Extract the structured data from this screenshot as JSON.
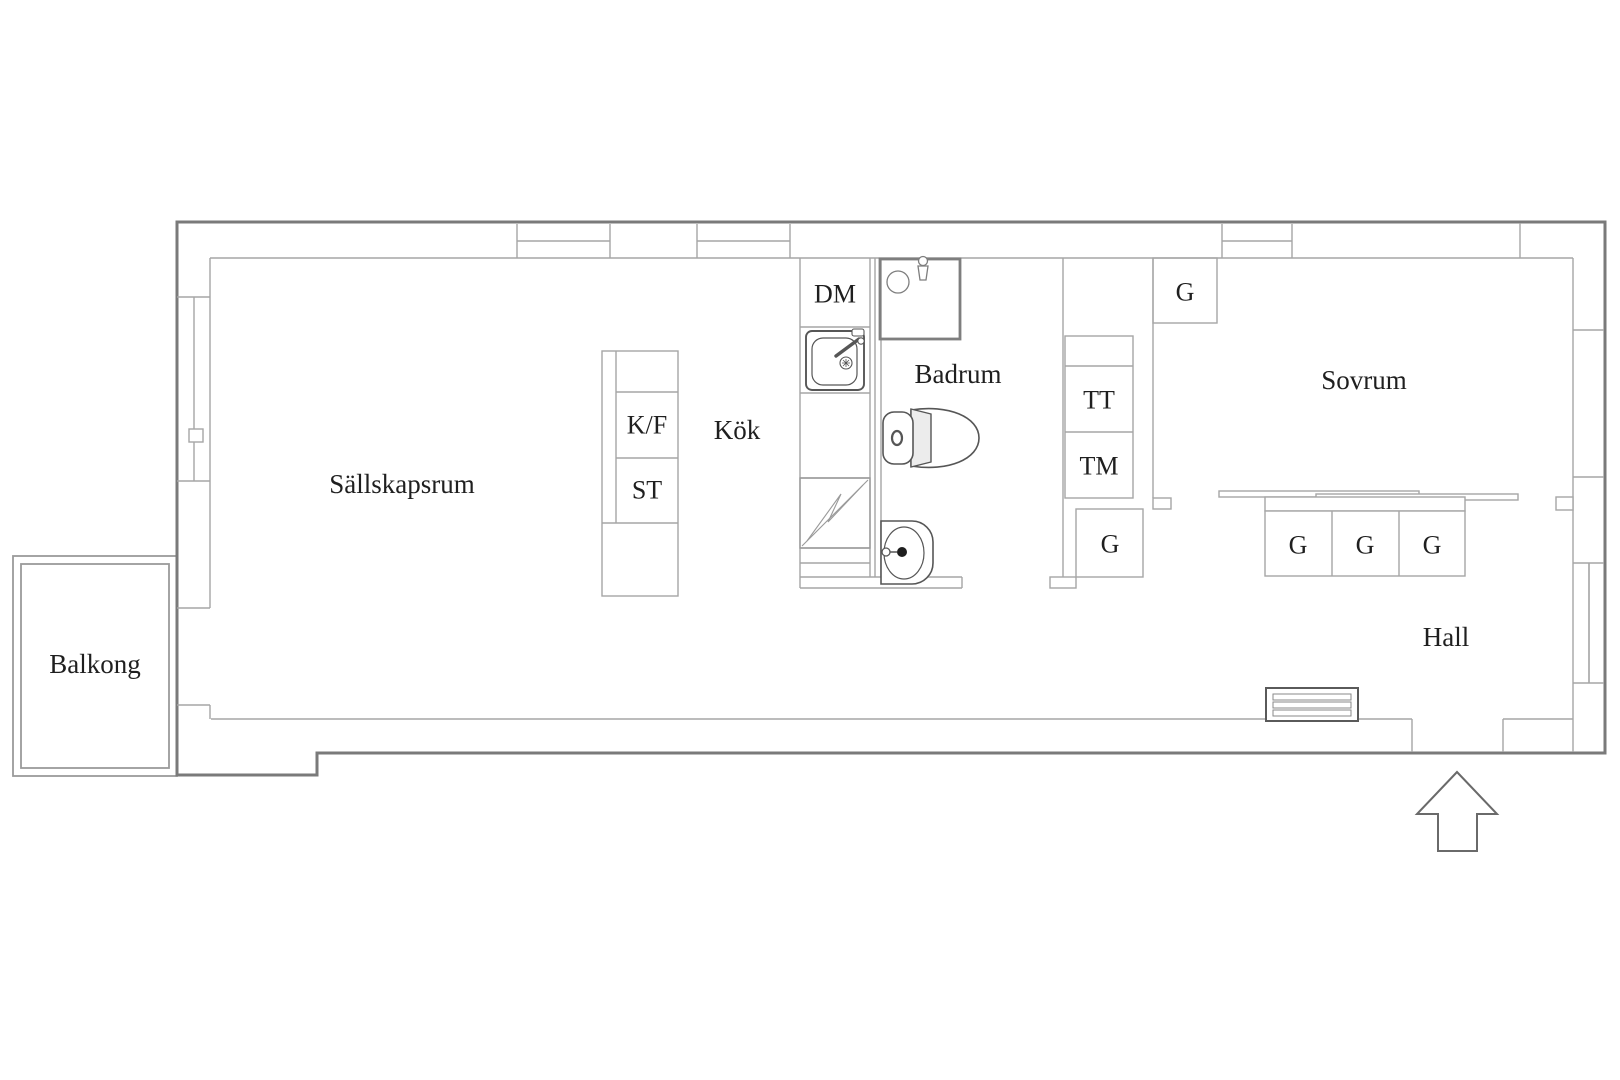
{
  "colors": {
    "background": "#ffffff",
    "exterior_wall": "#7a7a7a",
    "interior_line": "#a6a6a6",
    "fixture_line": "#565656",
    "text": "#1f1f1f"
  },
  "rooms": [
    {
      "id": "sallskapsrum",
      "label": "Sällskapsrum"
    },
    {
      "id": "balkong",
      "label": "Balkong"
    },
    {
      "id": "kok",
      "label": "Kök"
    },
    {
      "id": "badrum",
      "label": "Badrum"
    },
    {
      "id": "sovrum",
      "label": "Sovrum"
    },
    {
      "id": "hall",
      "label": "Hall"
    }
  ],
  "fixtures": [
    {
      "id": "fridge-freezer",
      "label": "K/F"
    },
    {
      "id": "tall-cabinet",
      "label": "ST"
    },
    {
      "id": "dishwasher",
      "label": "DM"
    },
    {
      "id": "tumble-dryer",
      "label": "TT"
    },
    {
      "id": "washing-machine",
      "label": "TM"
    },
    {
      "id": "wardrobe-bedroom",
      "label": "G"
    },
    {
      "id": "wardrobe-hall",
      "label": "G"
    },
    {
      "id": "wardrobe-closet-left",
      "label": "G"
    },
    {
      "id": "wardrobe-closet-middle",
      "label": "G"
    },
    {
      "id": "wardrobe-closet-right",
      "label": "G"
    }
  ],
  "icons": [
    "shower-icon",
    "toilet-icon",
    "washbasin-icon",
    "kitchen-sink-icon",
    "stove-icon",
    "vent-grille-icon",
    "entrance-arrow-icon",
    "window-icon"
  ]
}
